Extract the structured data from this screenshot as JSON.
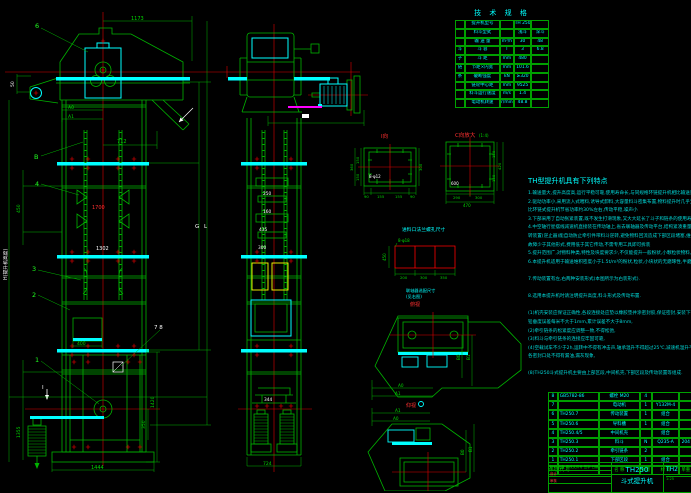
{
  "spec_table": {
    "title": "技 术 规 格",
    "rows": [
      {
        "group": "",
        "label": "提升机型号",
        "unit": "",
        "v1": "TH 250",
        "v2": ""
      },
      {
        "group": "",
        "label": "料斗型式",
        "unit": "",
        "v1": "浅斗",
        "v2": "深斗"
      },
      {
        "group": "",
        "label": "输 送 量",
        "unit": "m³/h",
        "v1": "30",
        "v2": "48"
      },
      {
        "group": "斗",
        "label": "斗  容",
        "unit": "l",
        "v1": "3",
        "v2": "6.8"
      },
      {
        "group": "子",
        "label": "斗  距",
        "unit": "mm",
        "v1": "480",
        "v2": ""
      },
      {
        "group": "链",
        "label": "节距×内宽",
        "unit": "mm",
        "v1": "101.6",
        "v2": ""
      },
      {
        "group": "条",
        "label": "破断强度",
        "unit": "kN",
        "v1": "≥320",
        "v2": ""
      },
      {
        "group": "",
        "label": "链轮中心距",
        "unit": "mm",
        "v1": "9525",
        "v2": ""
      },
      {
        "group": "",
        "label": "料斗运行速度",
        "unit": "m/s",
        "v1": "1.4",
        "v2": ""
      },
      {
        "group": "",
        "label": "电动机转速",
        "unit": "r/min",
        "v1": "48.8",
        "v2": ""
      }
    ]
  },
  "notes": {
    "title": "TH型提升机具有下列特点",
    "lines": [
      "1.输送量大,提升高度高,运行平稳可靠,使用寿命长,与同规格环链提升机相比输送量大一倍",
      "2.驱动功率小,采用流入式喂料,诱导式卸料,大容量料斗密集布置,物料提升时几乎无回料和挖料现象,故无效功率少",
      "  比环链式提升机节省功率约30%左右,传动平稳,噪声小",
      "3.下部采用了自动张紧装置,既不发生打滑现象,又大大延长了斗子和链条的使用寿命,工作更加安全可靠,故障率低",
      "4.中空轴行星摆线减速机直接装在传动轴上,省去联轴器及传动平台,结构紧凑重量轻,在断电或电机发生故障时,防逆",
      "  转装置(逆止器)能自动防止牵引件带料斗逆转,避免物料回流造成下部区段堵塞,维修量少,安装调试方便,",
      "  故障少于其他形式,费用低于其它传动,不需专用工具即可拆装",
      "5.提升范围广,对物料种类,特性及块度要求少,不仅能提升一般粉状,小颗粒状物料,而且可提升磨琢性较大的物料",
      "6.本提升机适用于输送堆积密度小于1.5t/m³的粉状,粒状,小块状的无磨琢性,半磨琢性物料,物料温度不超过250℃",
      "",
      "7.传动装置有左,右两种安装形式(本图所示为右装形式).",
      "",
      "8.选用本提升机时请注明提升高度,料斗形式及传动布置.",
      "",
      "(1)机壳安装应保证正确性,各段连接处应垫以橡胶垫并涂密封胶,保证密封,安装下部区段时,",
      "  铅垂度误差每米不大于1mm,累计误差不大于8mm,",
      "(2)牵引链条的松紧度应调整一致,不得松弛,",
      "(3)料斗与牵引链条的连接应牢固可靠,",
      "(4)空载试车不少于2h,运转中不得有冲击声,轴承温升不得超过25℃,减速机温升不超过30℃,ACY,Y系列,",
      "  各密封口处不得有漏油,漏灰现象,",
      "",
      "(8)TH250斗式提升机主要由上部区段,中间机壳,下部区段及传动装置等组成."
    ]
  },
  "parts_table": {
    "headers": [
      "件号",
      "代  号",
      "名  称",
      "数量",
      "材 料",
      "单重",
      "总重"
    ],
    "rows": [
      {
        "no": "8",
        "code": "GB5782-86",
        "name": "螺栓 M20",
        "qty": "4",
        "mat": "",
        "w1": "",
        "w2": ""
      },
      {
        "no": "7",
        "code": "",
        "name": "电动机",
        "qty": "1",
        "mat": "Y132M-4",
        "w1": "",
        "w2": ""
      },
      {
        "no": "6",
        "code": "TH250.7",
        "name": "传动装置",
        "qty": "1",
        "mat": "组合",
        "w1": "",
        "w2": ""
      },
      {
        "no": "5",
        "code": "TH250.6",
        "name": "导料槽",
        "qty": "1",
        "mat": "组合",
        "w1": "",
        "w2": ""
      },
      {
        "no": "4",
        "code": "TH250.4/5",
        "name": "中间机壳",
        "qty": "",
        "mat": "组合",
        "w1": "",
        "w2": ""
      },
      {
        "no": "3",
        "code": "TH250.3",
        "name": "料斗",
        "qty": "N",
        "mat": "Q235-A",
        "w1": "204",
        "w2": ""
      },
      {
        "no": "2",
        "code": "TH250.2",
        "name": "牵引链条",
        "qty": "2",
        "mat": "",
        "w1": "",
        "w2": ""
      },
      {
        "no": "1",
        "code": "TH250.1",
        "name": "下部区段",
        "qty": "1",
        "mat": "组合",
        "w1": "",
        "w2": ""
      }
    ]
  },
  "title_block": {
    "model": "TH250",
    "product": "斗式提升机",
    "drawing_no": "TH2",
    "rev_labels": "标记 处数 更改文件号 签字 日期",
    "designer_label": "设计",
    "checker_label": "审核",
    "scale": "1:25"
  },
  "labels": {
    "callout_6": "6",
    "dim_1173": "1173",
    "dim_50": "50",
    "dim_A0": "A0",
    "dim_A1": "A1",
    "dim_712": "712",
    "callout_B": "B",
    "callout_4": "4",
    "dim_450": "450",
    "dim_1700": "1700",
    "dim_1302": "1302",
    "callout_3": "3",
    "callout_2": "2",
    "dim_H": "H(提升机高度)",
    "dim_400": "400",
    "callout_78": "7  8",
    "section_I": "I",
    "callout_1": "1",
    "dim_1420": "1420",
    "dim_350": "350",
    "dim_1355": "1355",
    "dim_1444": "1444",
    "dim_L": "L",
    "dim_G": "G",
    "m_250": "250",
    "m_160": "160",
    "m_435": "435",
    "m_300": "300",
    "m_344": "344",
    "m_724": "724",
    "fi_label": "I向",
    "fi_90a": "90",
    "fi_155a": "155",
    "fi_155b": "155",
    "fi_90b": "90",
    "fi_150a": "150",
    "fi_150b": "150",
    "fi_360": "360",
    "fi_300": "300",
    "fi_holes": "8-φ12",
    "fc_label": "C向放大",
    "fc_scale": "(1:4)",
    "fc_150a": "150",
    "fc_150b": "150",
    "fc_420": "420",
    "fc_290": "290",
    "fc_300": "300",
    "fc_470": "470",
    "fc_600": "600",
    "bg_title": "进料口法兰螺孔尺寸",
    "bg_holes": "8-φ18",
    "bg_450": "450",
    "bg_200": "200",
    "bg_300": "300",
    "bg_350": "350",
    "bg_note1": "联轴器选配尺寸",
    "bg_note2": "(见右图)",
    "tv1_label": "俯视",
    "tv2_label": "仰视",
    "tv_A0": "A0",
    "tv_A1": "A1",
    "tv_B0": "B0",
    "tv_B1": "B1"
  }
}
